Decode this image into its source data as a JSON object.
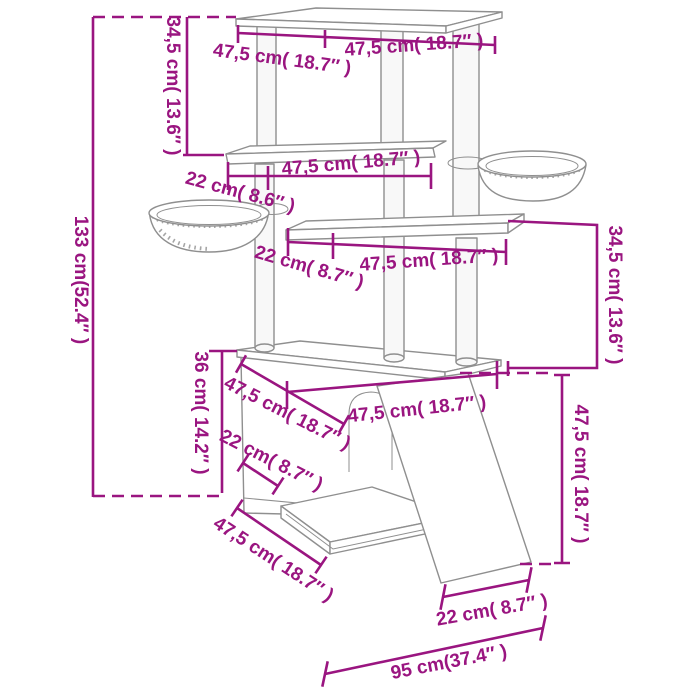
{
  "diagram": {
    "subject": "cat-tree-dimension-diagram",
    "units": [
      "cm",
      "inch"
    ]
  },
  "colors": {
    "dimension": "#9A1580",
    "linework": "#8F8F8F",
    "background": "#FFFFFF"
  },
  "labels": [
    {
      "id": "top-depth",
      "text": "47,5 cm( 18.7″ )"
    },
    {
      "id": "top-width",
      "text": "47,5 cm( 18.7″ )"
    },
    {
      "id": "upper-height",
      "text": "34,5 cm( 13.6″ )"
    },
    {
      "id": "total-height",
      "text": "133 cm(52.4″ )"
    },
    {
      "id": "shelf2-width",
      "text": "47,5 cm( 18.7″ )"
    },
    {
      "id": "shelf2-depth",
      "text": "22 cm( 8.6″ )"
    },
    {
      "id": "shelf3-depth",
      "text": "22 cm( 8.7″ )"
    },
    {
      "id": "shelf3-width",
      "text": "47,5 cm( 18.7″ )"
    },
    {
      "id": "mid-height",
      "text": "34,5 cm( 13.6″ )"
    },
    {
      "id": "condo-top-width",
      "text": "47,5 cm( 18.7″ )"
    },
    {
      "id": "condo-top-depth",
      "text": "47,5 cm( 18.7″ )"
    },
    {
      "id": "condo-shelf-depth",
      "text": "22 cm( 8.7″ )"
    },
    {
      "id": "condo-height",
      "text": "36 cm( 14.2″ )"
    },
    {
      "id": "ramp-height",
      "text": "47,5 cm( 18.7″ )"
    },
    {
      "id": "base-depth",
      "text": "47,5 cm( 18.7″ )"
    },
    {
      "id": "ramp-foot-depth",
      "text": "22 cm( 8.7″ )"
    },
    {
      "id": "total-width",
      "text": "95 cm(37.4″ )"
    }
  ]
}
